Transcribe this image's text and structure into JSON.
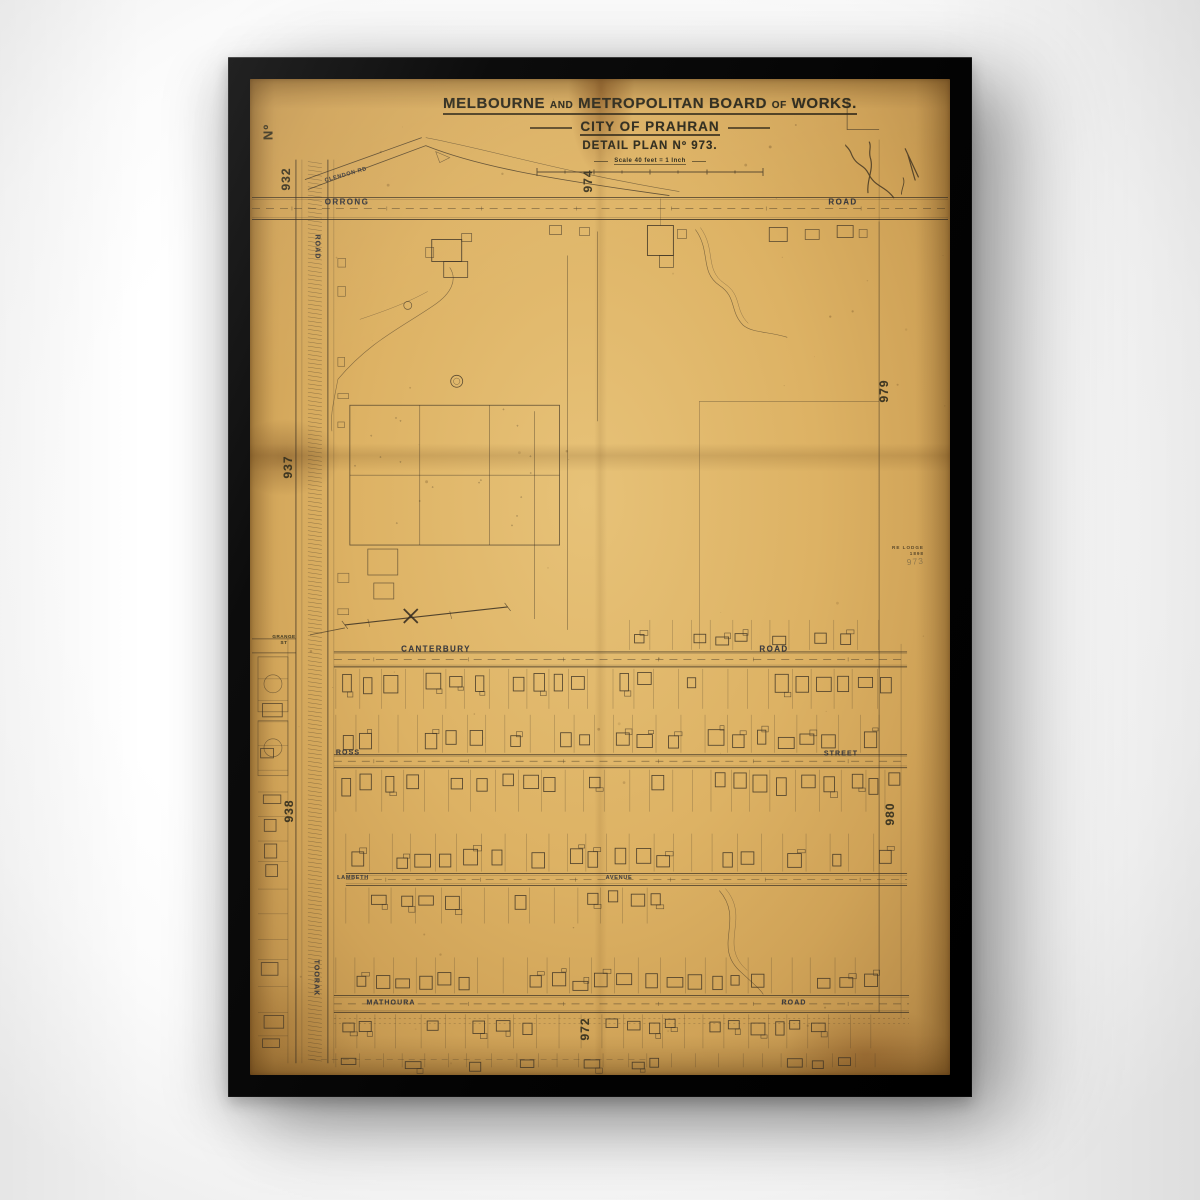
{
  "artwork": {
    "board": {
      "w1": "MELBOURNE",
      "sep1": "AND",
      "w2": "METROPOLITAN BOARD",
      "sep2": "OF",
      "w3": "WORKS."
    },
    "subtitle": "CITY OF PRAHRAN",
    "plan_line": "DETAIL PLAN Nº 973.",
    "scale_text": "Scale 40 feet = 1 Inch"
  },
  "adjoining_plans": {
    "no_label": "Nº",
    "top": "974",
    "left_top": "932",
    "left_mid": "937",
    "left_low": "938",
    "right_top": "979",
    "right_low": "980",
    "bottom": "972"
  },
  "streets": {
    "orrong": {
      "name": "ORRONG",
      "type": "ROAD"
    },
    "clendon": {
      "name": "CLENDON",
      "type": "RD"
    },
    "toorak": {
      "name": "TOORAK",
      "type": "ROAD"
    },
    "grange": {
      "name": "GRANGE",
      "type": "ST"
    },
    "canterbury": {
      "name": "CANTERBURY",
      "type": "ROAD"
    },
    "ross": {
      "name": "ROSS",
      "type": "STREET"
    },
    "avenue": {
      "name": "LAMBETH",
      "type": "AVENUE"
    },
    "mathoura": {
      "name": "MATHOURA",
      "type": "ROAD"
    }
  },
  "stamp": {
    "line1": "RE LODGE",
    "line2": "1898",
    "pencil": "973"
  },
  "colors": {
    "paper": "#dcb166",
    "ink": "#3a3023",
    "street_label": "#2a2f3d",
    "frame": "#0a0a0a",
    "pencil": "#86714a"
  }
}
